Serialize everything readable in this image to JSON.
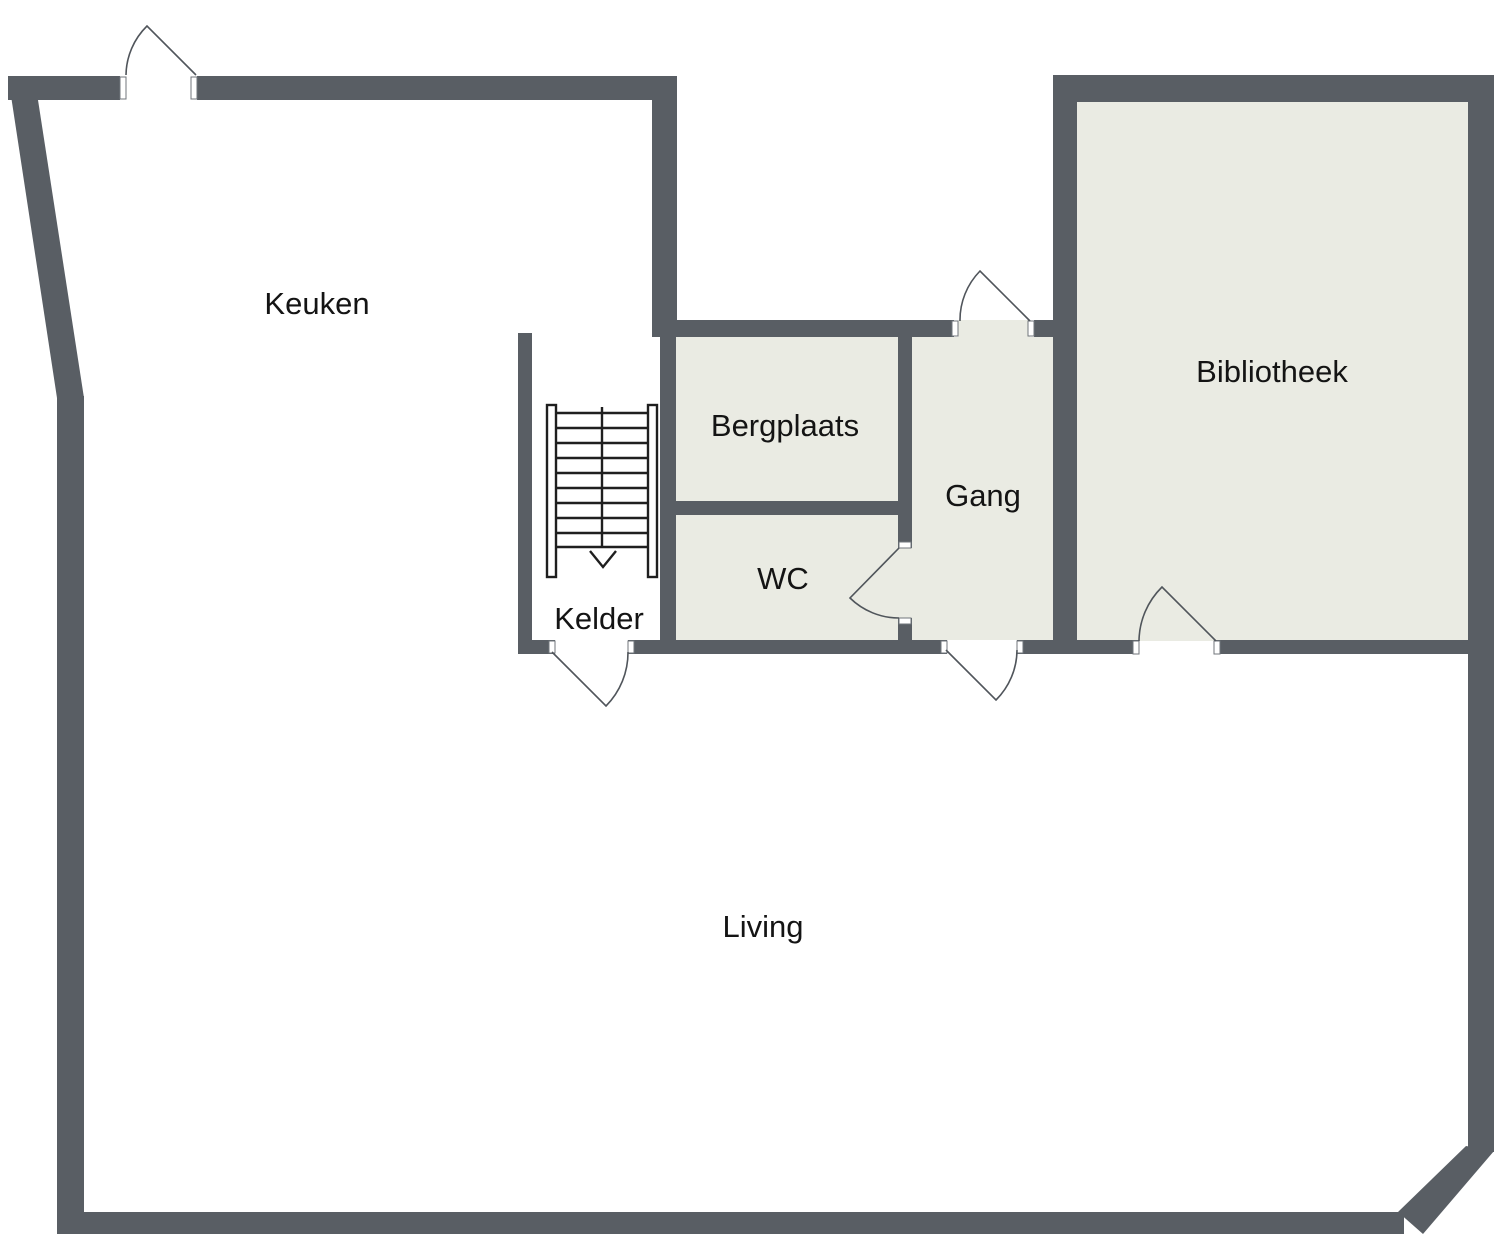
{
  "palette": {
    "wall": "#595e64",
    "room_fill": "#eaebe3",
    "door_line": "#50555b",
    "label": "#141414",
    "background": "#ffffff"
  },
  "rooms": {
    "keuken": {
      "label": "Keuken"
    },
    "bergplaats": {
      "label": "Bergplaats"
    },
    "gang": {
      "label": "Gang"
    },
    "bibliotheek": {
      "label": "Bibliotheek"
    },
    "wc": {
      "label": "WC"
    },
    "kelder": {
      "label": "Kelder"
    },
    "living": {
      "label": "Living"
    }
  },
  "stairs": {
    "treads": 10,
    "arrow_direction": "down"
  }
}
